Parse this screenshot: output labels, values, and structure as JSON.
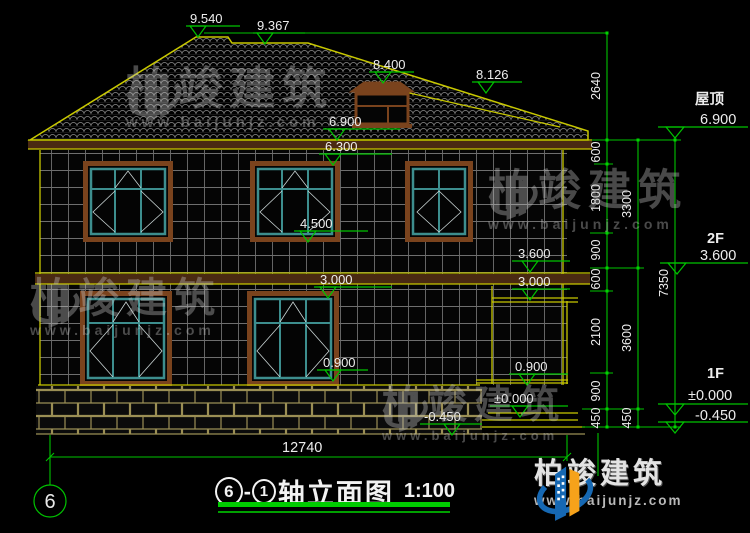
{
  "brand": {
    "name": "柏竣建筑",
    "url": "www.baijunjz.com"
  },
  "title": {
    "axis_left": "6",
    "separator": "-",
    "axis_right": "1",
    "text": "轴立面图",
    "scale": "1:100"
  },
  "axis_bubble": {
    "label": "6"
  },
  "levels": {
    "m9540": "9.540",
    "m9367": "9.367",
    "m8400": "8.400",
    "m8126": "8.126",
    "m6900": "6.900",
    "m6300": "6.300",
    "m4500": "4.500",
    "m3000a": "3.000",
    "m3600": "3.600",
    "m3000b": "3.000",
    "m0900a": "0.900",
    "m0900b": "0.900",
    "m0000": "±0.000",
    "mneg450": "-0.450"
  },
  "right_labels": {
    "roof_name": "屋顶",
    "roof_level": "6.900",
    "f2_name": "2F",
    "f2_level": "3.600",
    "f1_name": "1F",
    "f1_level": "±0.000",
    "base_level": "-0.450"
  },
  "dims": {
    "chain_inner": [
      "2640",
      "600",
      "1800",
      "900",
      "600",
      "2100",
      "900",
      "450"
    ],
    "chain_mid": [
      "3300",
      "3600",
      "450"
    ],
    "chain_outer": "7350",
    "total_width": "12740"
  },
  "colors": {
    "dimension_green": "#00c300",
    "outline_yellow": "#c8c800",
    "frame_teal": "#3d8e8e",
    "trim_brown": "#7a431d",
    "logo_blue": "#1668b3",
    "logo_orange": "#f6a21a"
  }
}
